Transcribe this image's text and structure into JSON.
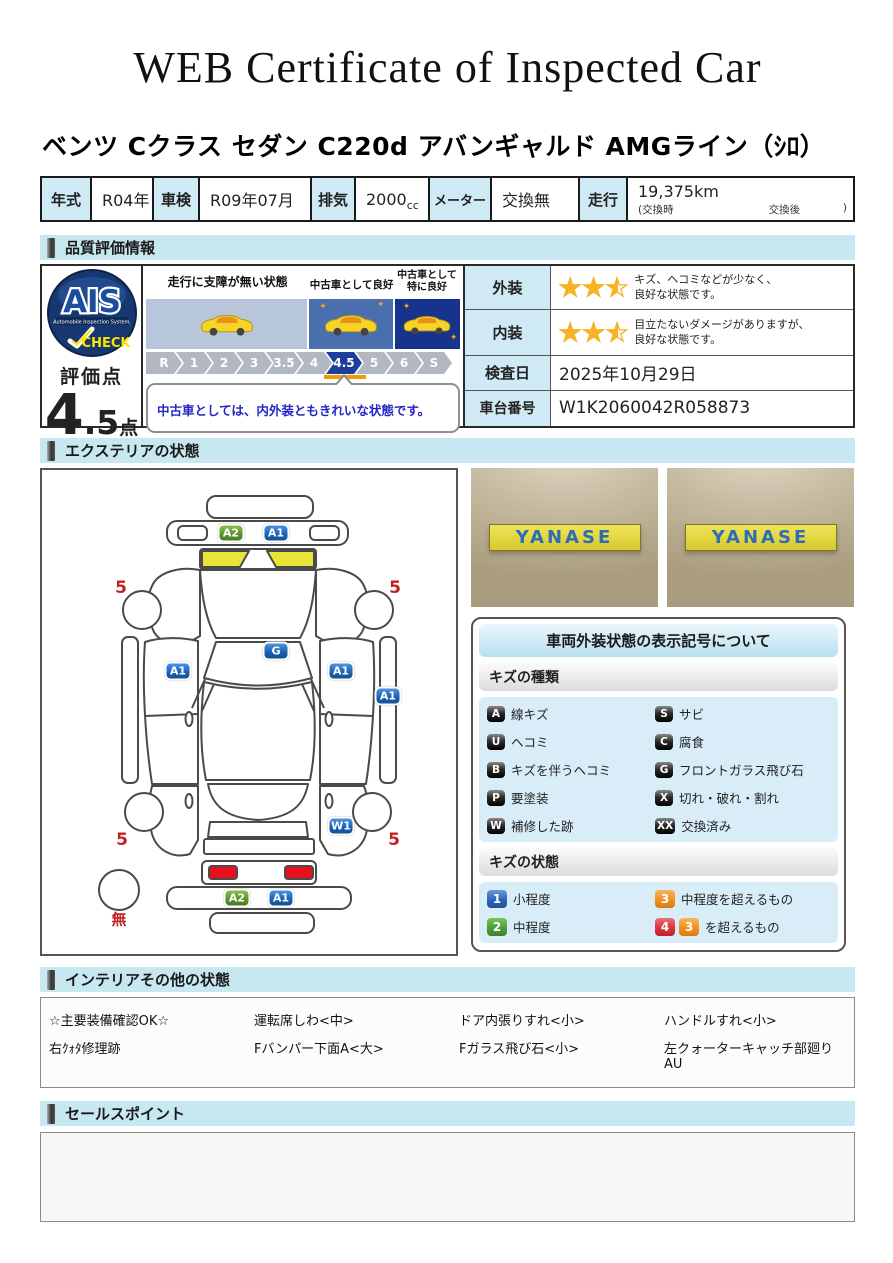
{
  "title": "WEB Certificate of Inspected Car",
  "car_name": "ベンツ Cクラス セダン C220d アバンギャルド AMGライン（ｼﾛ）",
  "spec": {
    "year_label": "年式",
    "year": "R04年",
    "shaken_label": "車検",
    "shaken": "R09年07月",
    "disp_label": "排気",
    "disp": "2000",
    "disp_unit": "cc",
    "meter_label": "メーター",
    "meter": "交換無",
    "mileage_label": "走行",
    "mileage": "19,375km",
    "mileage_note_open": "(交換時",
    "mileage_note_mid": "交換後",
    "mileage_note_close": ")"
  },
  "sections": {
    "quality": "品質評価情報",
    "exterior": "エクステリアの状態",
    "interior": "インテリアその他の状態",
    "sales": "セールスポイント"
  },
  "quality": {
    "logo": {
      "brand": "AIS",
      "sub": "Automobile Inspection System.",
      "check": "CHECK"
    },
    "score_label": "評価点",
    "score_main": "4",
    "score_decimal": ".5",
    "score_unit": "点",
    "zones": [
      {
        "label": "走行に支障が無い状態",
        "color": "#b7c6da"
      },
      {
        "label": "中古車として良好",
        "color": "#4a6fae"
      },
      {
        "label": "中古車として\n特に良好",
        "color": "#17338c"
      }
    ],
    "scale": [
      "R",
      "1",
      "2",
      "3",
      "3.5",
      "4",
      "4.5",
      "5",
      "6",
      "S"
    ],
    "scale_active": "4.5",
    "comment": "中古車としては、内外装ともきれいな状態です。",
    "stars_glyphs": "★★★",
    "rows": [
      {
        "label": "外装",
        "stars": 2.5,
        "text": "キズ、ヘコミなどが少なく、\n良好な状態です。"
      },
      {
        "label": "内装",
        "stars": 2.5,
        "text": "目立たないダメージがありますが、\n良好な状態です。"
      },
      {
        "label": "検査日",
        "value": "2025年10月29日"
      },
      {
        "label": "車台番号",
        "value": "W1K2060042R058873"
      }
    ]
  },
  "exterior": {
    "photo_sign": "YANASE",
    "diagram": {
      "badges": [
        {
          "code": "A2",
          "color": "green",
          "part": "front-bumper"
        },
        {
          "code": "A1",
          "color": "blue",
          "part": "front-bumper"
        },
        {
          "code": "G",
          "color": "blue",
          "part": "windshield"
        },
        {
          "code": "A1",
          "color": "blue",
          "part": "left-front-door"
        },
        {
          "code": "A1",
          "color": "blue",
          "part": "right-front-door"
        },
        {
          "code": "A1",
          "color": "blue",
          "part": "right-rocker"
        },
        {
          "code": "W1",
          "color": "blue",
          "part": "right-rear-quarter"
        },
        {
          "code": "A2",
          "color": "green",
          "part": "rear-bumper"
        },
        {
          "code": "A1",
          "color": "blue",
          "part": "rear-bumper"
        }
      ],
      "tread_labels": [
        "5",
        "5",
        "5",
        "5"
      ],
      "spare_label": "無"
    },
    "legend": {
      "title": "車両外装状態の表示記号について",
      "kind_header": "キズの種類",
      "kinds": [
        {
          "code": "A",
          "label": "線キズ"
        },
        {
          "code": "S",
          "label": "サビ"
        },
        {
          "code": "U",
          "label": "ヘコミ"
        },
        {
          "code": "C",
          "label": "腐食"
        },
        {
          "code": "B",
          "label": "キズを伴うヘコミ"
        },
        {
          "code": "G",
          "label": "フロントガラス飛び石"
        },
        {
          "code": "P",
          "label": "要塗装"
        },
        {
          "code": "X",
          "label": "切れ・破れ・割れ"
        },
        {
          "code": "W",
          "label": "補修した跡"
        },
        {
          "code": "XX",
          "label": "交換済み"
        }
      ],
      "state_header": "キズの状態",
      "states": [
        {
          "code": "1",
          "label": "小程度"
        },
        {
          "code": "3",
          "label": "中程度を超えるもの"
        },
        {
          "code": "2",
          "label": "中程度"
        },
        {
          "codes": [
            "4",
            "3"
          ],
          "label": "を超えるもの"
        }
      ]
    }
  },
  "interior": {
    "items": [
      "☆主要装備確認OK☆",
      "運転席しわ<中>",
      "ドア内張りすれ<小>",
      "ハンドルすれ<小>",
      "右ｸｫﾀ修理跡",
      "Fバンパー下面A<大>",
      "Fガラス飛び石<小>",
      "左クォーターキャッチ部廻りAU"
    ]
  },
  "sales": {
    "content": ""
  }
}
